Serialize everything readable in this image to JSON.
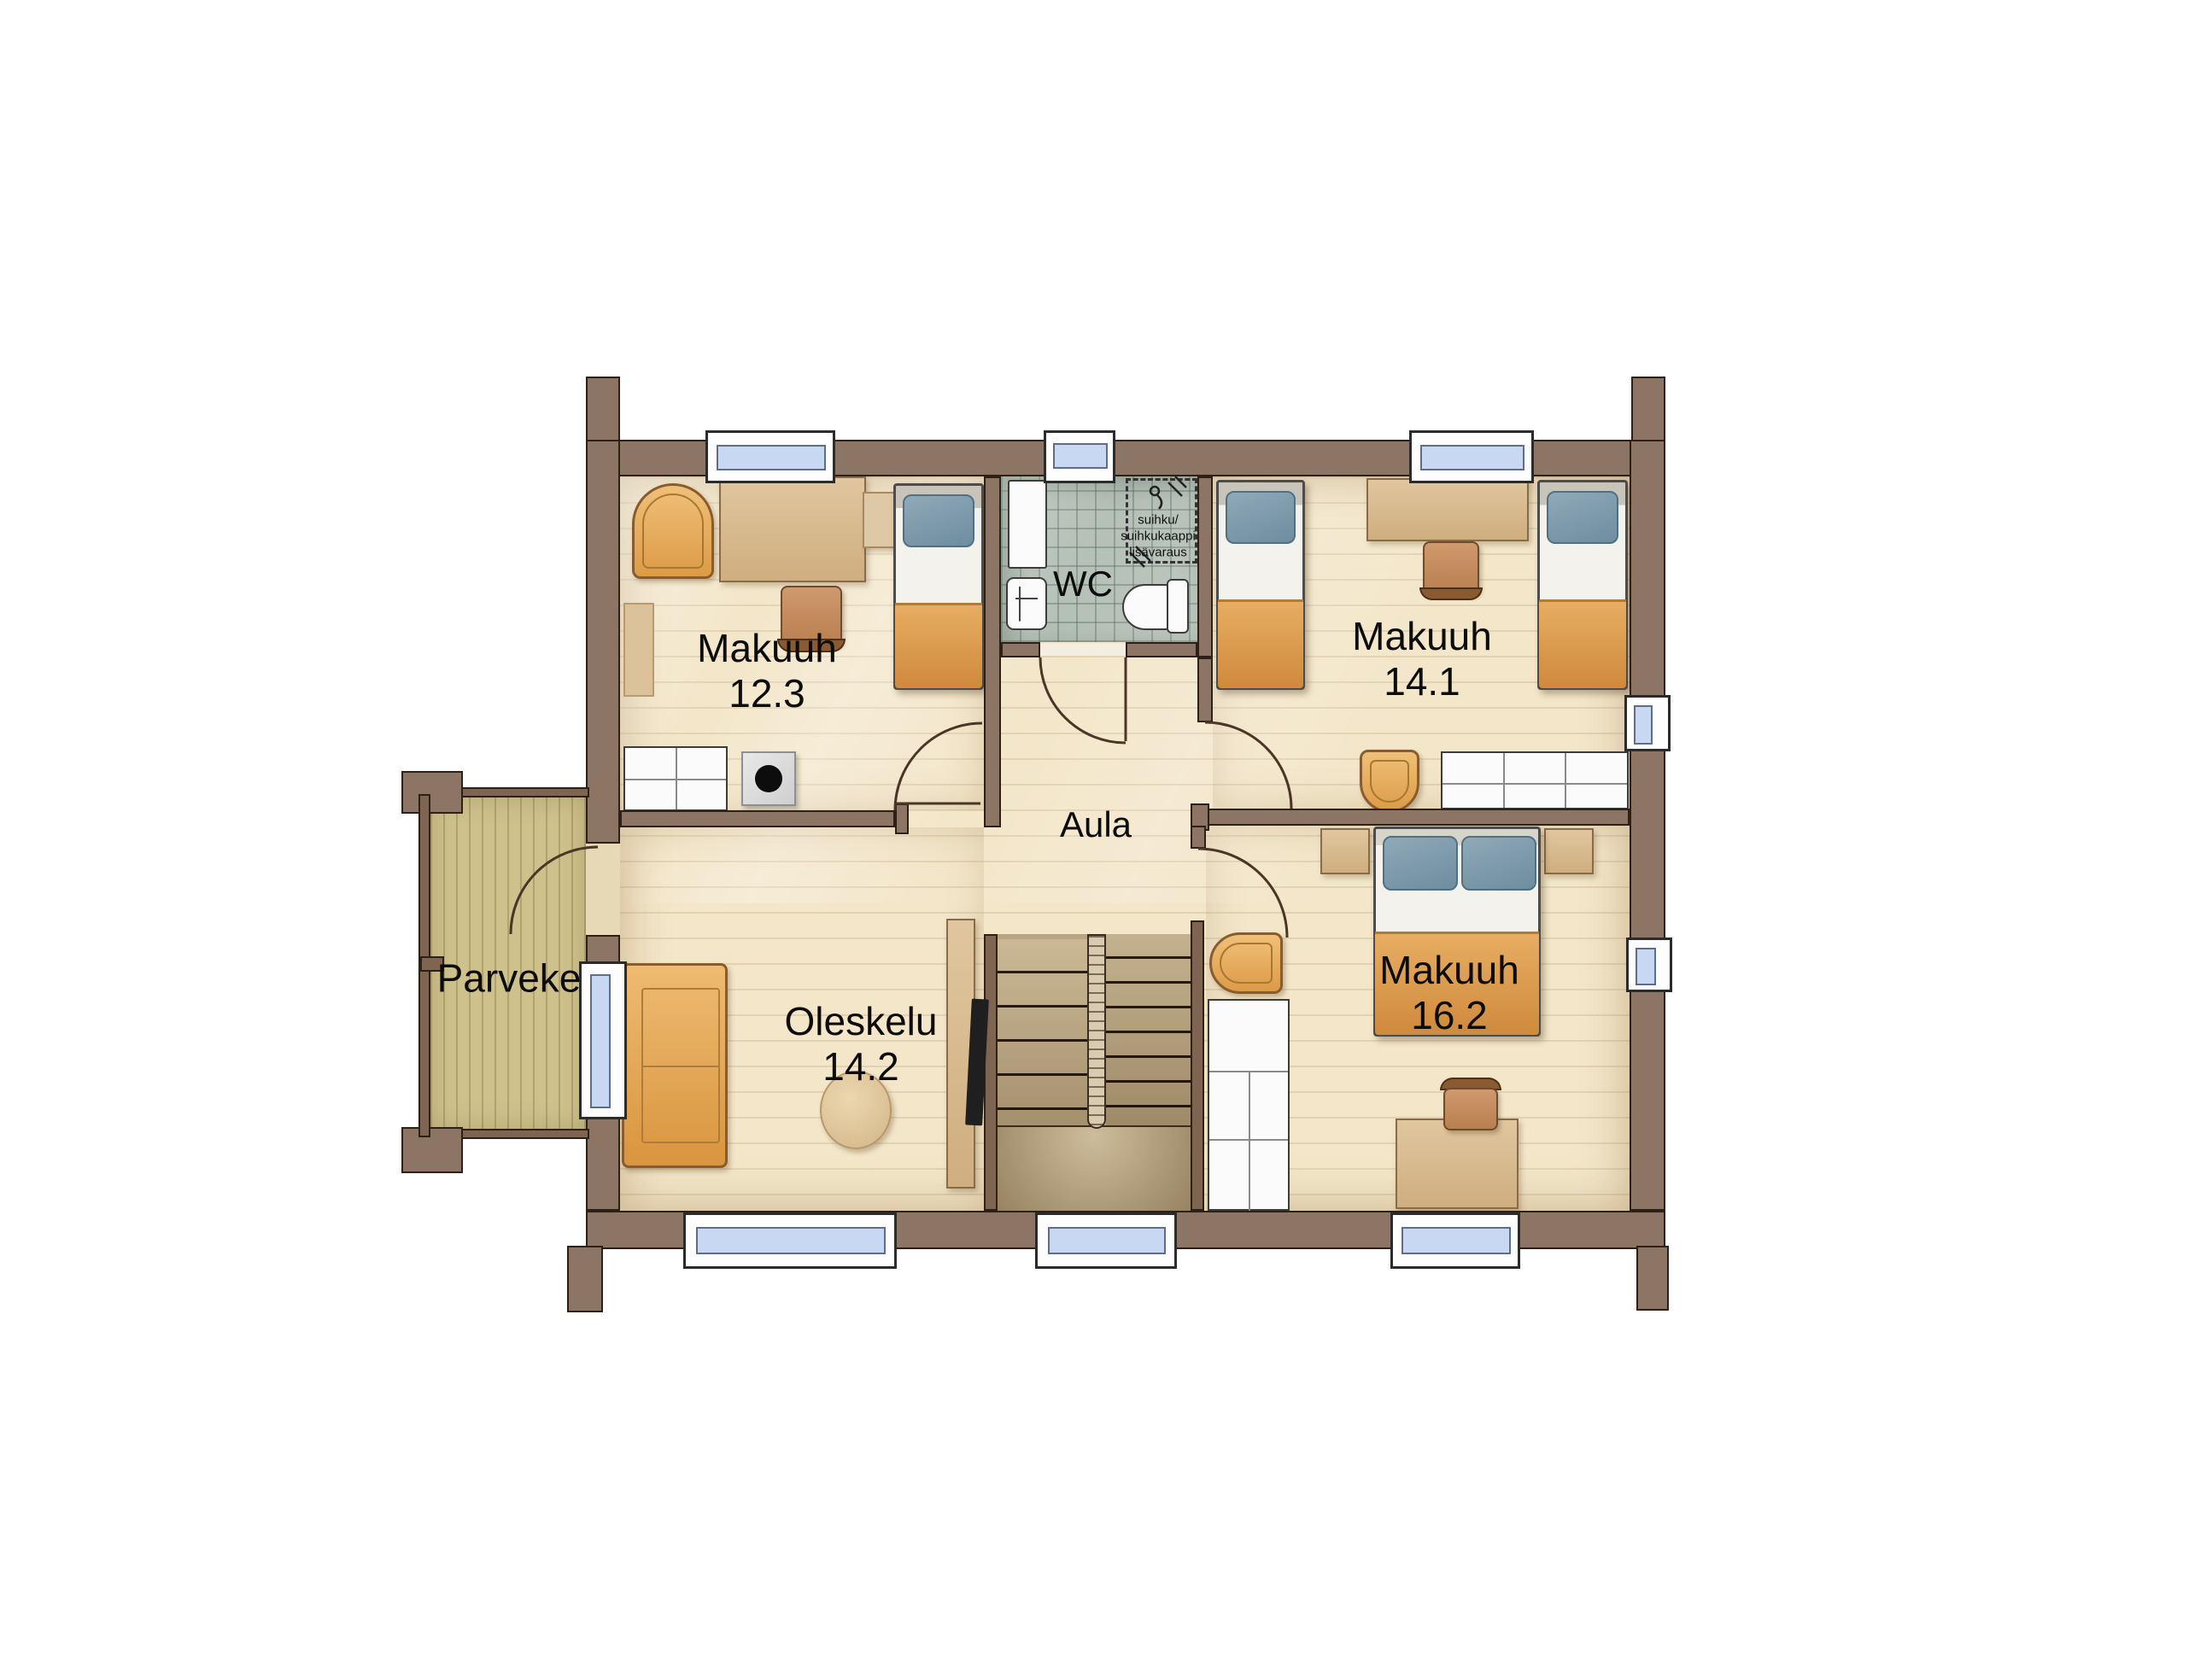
{
  "rooms": {
    "bedroom_small": {
      "name": "Makuuh",
      "area": "12.3"
    },
    "bedroom_mid": {
      "name": "Makuuh",
      "area": "14.1"
    },
    "bedroom_large": {
      "name": "Makuuh",
      "area": "16.2"
    },
    "living": {
      "name": "Oleskelu",
      "area": "14.2"
    },
    "hall": {
      "name": "Aula"
    },
    "wc": {
      "name": "WC"
    },
    "balcony": {
      "name": "Parveke"
    }
  },
  "wc_note": {
    "line1": "suihku/",
    "line2": "suihkukaappi",
    "line3": "lisävaraus"
  },
  "colors": {
    "wall": "#8d7566",
    "floor": "#f3e6c9",
    "balcony_floor": "#cfc18c",
    "wc_tile": "#b5c0b7",
    "furniture_orange": "#dc9b47",
    "pillow_blue": "#7d9cac",
    "blanket_orange": "#e1a257",
    "window_glass": "#c9d8f2"
  }
}
